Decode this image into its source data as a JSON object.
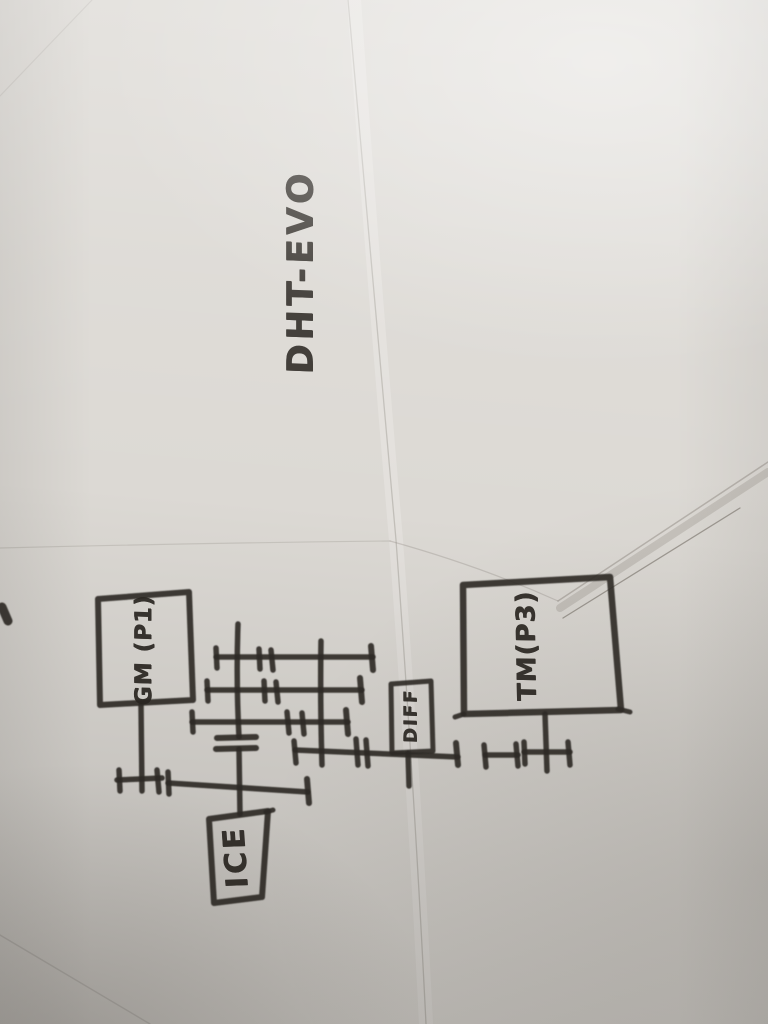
{
  "photo": {
    "title_text": "DHT-EVO",
    "labels": {
      "gm": "GM (P1)",
      "ice": "ICE",
      "diff": "DIFF",
      "tm": "TM(P3)"
    },
    "colors": {
      "paper": "#dcd9d4",
      "ink": "#2e2a26"
    }
  }
}
